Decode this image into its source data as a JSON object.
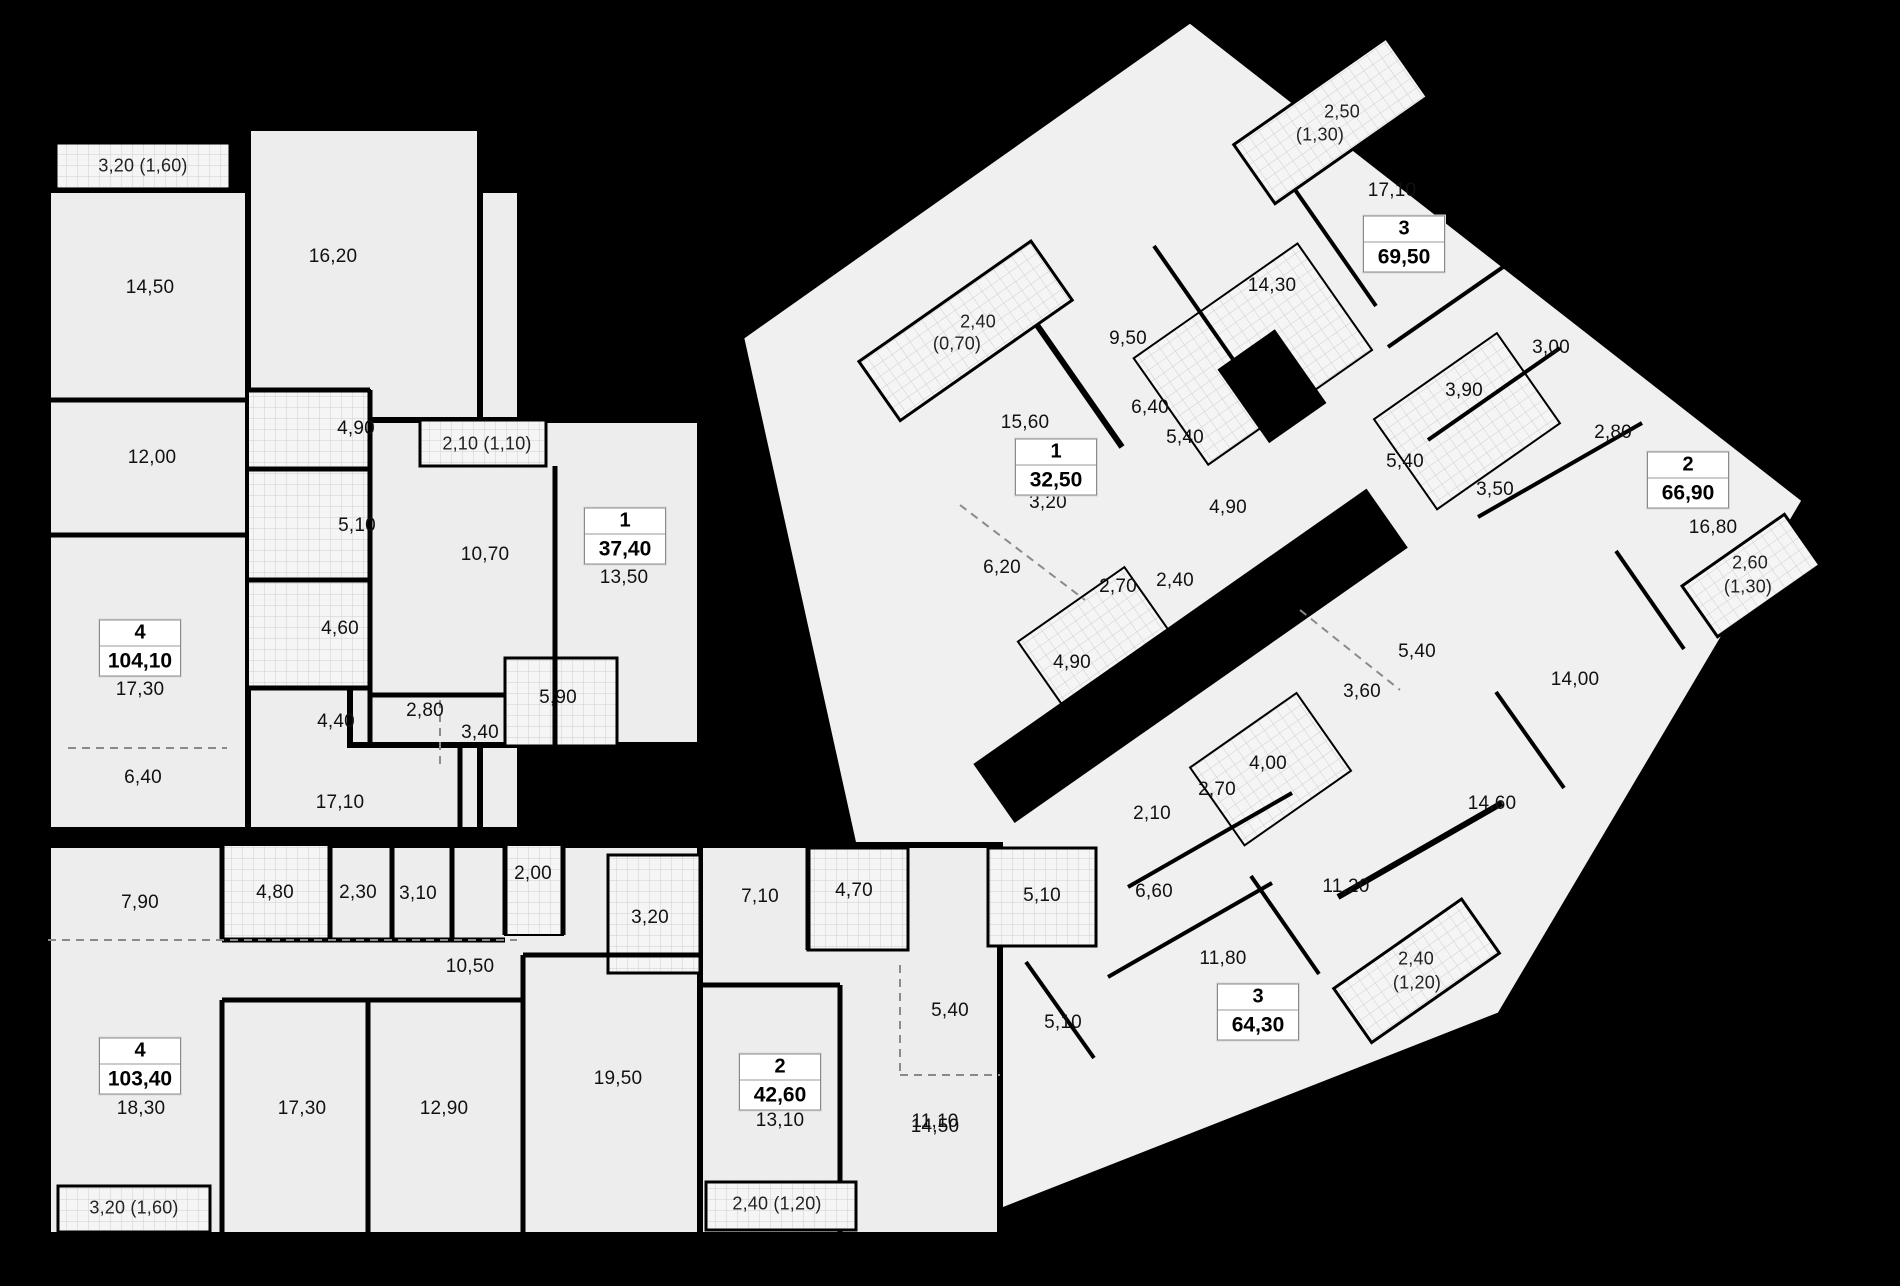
{
  "plan_title": "residential floor plan",
  "colors": {
    "background": "#000000",
    "floor_fill": "#ededed",
    "floor_fill_light": "#f3f3f3",
    "wall": "#000000",
    "tile_fill": "#f5f5f5",
    "tile_line": "#cfcfcf",
    "label_text": "#111111"
  },
  "apartments": [
    {
      "rooms_count": "4",
      "total_area": "104,10",
      "badge": {
        "x": 140,
        "y": 648
      },
      "room_labels": [
        {
          "t": "14,50",
          "x": 150,
          "y": 288
        },
        {
          "t": "16,20",
          "x": 333,
          "y": 257
        },
        {
          "t": "12,00",
          "x": 152,
          "y": 458
        },
        {
          "t": "4,90",
          "x": 356,
          "y": 429
        },
        {
          "t": "5,10",
          "x": 357,
          "y": 526
        },
        {
          "t": "4,60",
          "x": 340,
          "y": 629
        },
        {
          "t": "17,30",
          "x": 140,
          "y": 690
        },
        {
          "t": "6,40",
          "x": 143,
          "y": 778
        },
        {
          "t": "4,40",
          "x": 336,
          "y": 722
        },
        {
          "t": "17,10",
          "x": 340,
          "y": 803
        }
      ],
      "balcony_labels": [
        {
          "t": "3,20 (1,60)",
          "x": 143,
          "y": 166
        }
      ]
    },
    {
      "rooms_count": "1",
      "total_area": "37,40",
      "badge": {
        "x": 625,
        "y": 536
      },
      "room_labels": [
        {
          "t": "13,50",
          "x": 624,
          "y": 578
        },
        {
          "t": "10,70",
          "x": 485,
          "y": 555
        },
        {
          "t": "5,90",
          "x": 558,
          "y": 698
        },
        {
          "t": "2,80",
          "x": 425,
          "y": 711
        },
        {
          "t": "3,40",
          "x": 480,
          "y": 733
        }
      ],
      "balcony_labels": [
        {
          "t": "2,10 (1,10)",
          "x": 487,
          "y": 444
        }
      ]
    },
    {
      "rooms_count": "4",
      "total_area": "103,40",
      "badge": {
        "x": 140,
        "y": 1066
      },
      "room_labels": [
        {
          "t": "7,90",
          "x": 140,
          "y": 903
        },
        {
          "t": "4,80",
          "x": 275,
          "y": 893
        },
        {
          "t": "2,30",
          "x": 358,
          "y": 893
        },
        {
          "t": "3,10",
          "x": 418,
          "y": 894
        },
        {
          "t": "2,00",
          "x": 533,
          "y": 874
        },
        {
          "t": "3,20",
          "x": 650,
          "y": 918
        },
        {
          "t": "10,50",
          "x": 470,
          "y": 967
        },
        {
          "t": "18,30",
          "x": 141,
          "y": 1109
        },
        {
          "t": "17,30",
          "x": 302,
          "y": 1109
        },
        {
          "t": "12,90",
          "x": 444,
          "y": 1109
        },
        {
          "t": "19,50",
          "x": 618,
          "y": 1079
        }
      ],
      "balcony_labels": [
        {
          "t": "3,20 (1,60)",
          "x": 134,
          "y": 1208
        }
      ]
    },
    {
      "rooms_count": "2",
      "total_area": "42,60",
      "badge": {
        "x": 780,
        "y": 1082
      },
      "room_labels": [
        {
          "t": "7,10",
          "x": 760,
          "y": 897
        },
        {
          "t": "4,70",
          "x": 854,
          "y": 891
        },
        {
          "t": "5,10",
          "x": 1042,
          "y": 896
        },
        {
          "t": "5,40",
          "x": 950,
          "y": 1011
        },
        {
          "t": "13,10",
          "x": 780,
          "y": 1121
        },
        {
          "t": "11,10",
          "x": 935,
          "y": 1122
        }
      ],
      "balcony_labels": [
        {
          "t": "2,40 (1,20)",
          "x": 777,
          "y": 1204
        }
      ]
    },
    {
      "rooms_count": "1",
      "total_area": "32,50",
      "badge": {
        "x": 1056,
        "y": 467
      },
      "room_labels": [
        {
          "t": "15,60",
          "x": 1025,
          "y": 423
        },
        {
          "t": "6,40",
          "x": 1150,
          "y": 408
        },
        {
          "t": "3,20",
          "x": 1048,
          "y": 503
        },
        {
          "t": "6,20",
          "x": 1002,
          "y": 568
        },
        {
          "t": "2,70",
          "x": 1118,
          "y": 587
        },
        {
          "t": "2,40",
          "x": 1175,
          "y": 581
        },
        {
          "t": "4,90",
          "x": 1072,
          "y": 663
        }
      ],
      "balcony_labels": [
        {
          "t": "2,40",
          "x": 978,
          "y": 322
        },
        {
          "t": "(0,70)",
          "x": 957,
          "y": 344
        }
      ]
    },
    {
      "rooms_count": "3",
      "total_area": "69,50",
      "badge": {
        "x": 1404,
        "y": 244
      },
      "room_labels": [
        {
          "t": "17,10",
          "x": 1392,
          "y": 191
        },
        {
          "t": "14,30",
          "x": 1272,
          "y": 286
        },
        {
          "t": "9,50",
          "x": 1128,
          "y": 339
        },
        {
          "t": "3,00",
          "x": 1551,
          "y": 348
        },
        {
          "t": "3,90",
          "x": 1464,
          "y": 391
        },
        {
          "t": "5,40",
          "x": 1185,
          "y": 438
        },
        {
          "t": "4,90",
          "x": 1228,
          "y": 508
        }
      ],
      "balcony_labels": [
        {
          "t": "2,50",
          "x": 1342,
          "y": 112
        },
        {
          "t": "(1,30)",
          "x": 1320,
          "y": 135
        }
      ]
    },
    {
      "rooms_count": "2",
      "total_area": "66,90",
      "badge": {
        "x": 1688,
        "y": 480
      },
      "room_labels": [
        {
          "t": "2,80",
          "x": 1613,
          "y": 433
        },
        {
          "t": "3,50",
          "x": 1495,
          "y": 490
        },
        {
          "t": "5,40",
          "x": 1405,
          "y": 462
        },
        {
          "t": "16,80",
          "x": 1713,
          "y": 528
        },
        {
          "t": "14,00",
          "x": 1575,
          "y": 680
        },
        {
          "t": "5,40",
          "x": 1417,
          "y": 652
        },
        {
          "t": "3,60",
          "x": 1362,
          "y": 692
        },
        {
          "t": "14,60",
          "x": 1492,
          "y": 804
        }
      ],
      "balcony_labels": [
        {
          "t": "2,60",
          "x": 1750,
          "y": 563
        },
        {
          "t": "(1,30)",
          "x": 1748,
          "y": 587
        }
      ]
    },
    {
      "rooms_count": "3",
      "total_area": "64,30",
      "badge": {
        "x": 1258,
        "y": 1012
      },
      "room_labels": [
        {
          "t": "4,00",
          "x": 1268,
          "y": 764
        },
        {
          "t": "2,70",
          "x": 1217,
          "y": 790
        },
        {
          "t": "2,10",
          "x": 1152,
          "y": 814
        },
        {
          "t": "6,60",
          "x": 1154,
          "y": 892
        },
        {
          "t": "11,20",
          "x": 1346,
          "y": 887
        },
        {
          "t": "11,80",
          "x": 1223,
          "y": 959
        },
        {
          "t": "5,10",
          "x": 1063,
          "y": 1023
        },
        {
          "t": "14,50",
          "x": 935,
          "y": 1127
        }
      ],
      "balcony_labels": [
        {
          "t": "2,40",
          "x": 1416,
          "y": 959
        },
        {
          "t": "(1,20)",
          "x": 1417,
          "y": 983
        }
      ]
    }
  ]
}
